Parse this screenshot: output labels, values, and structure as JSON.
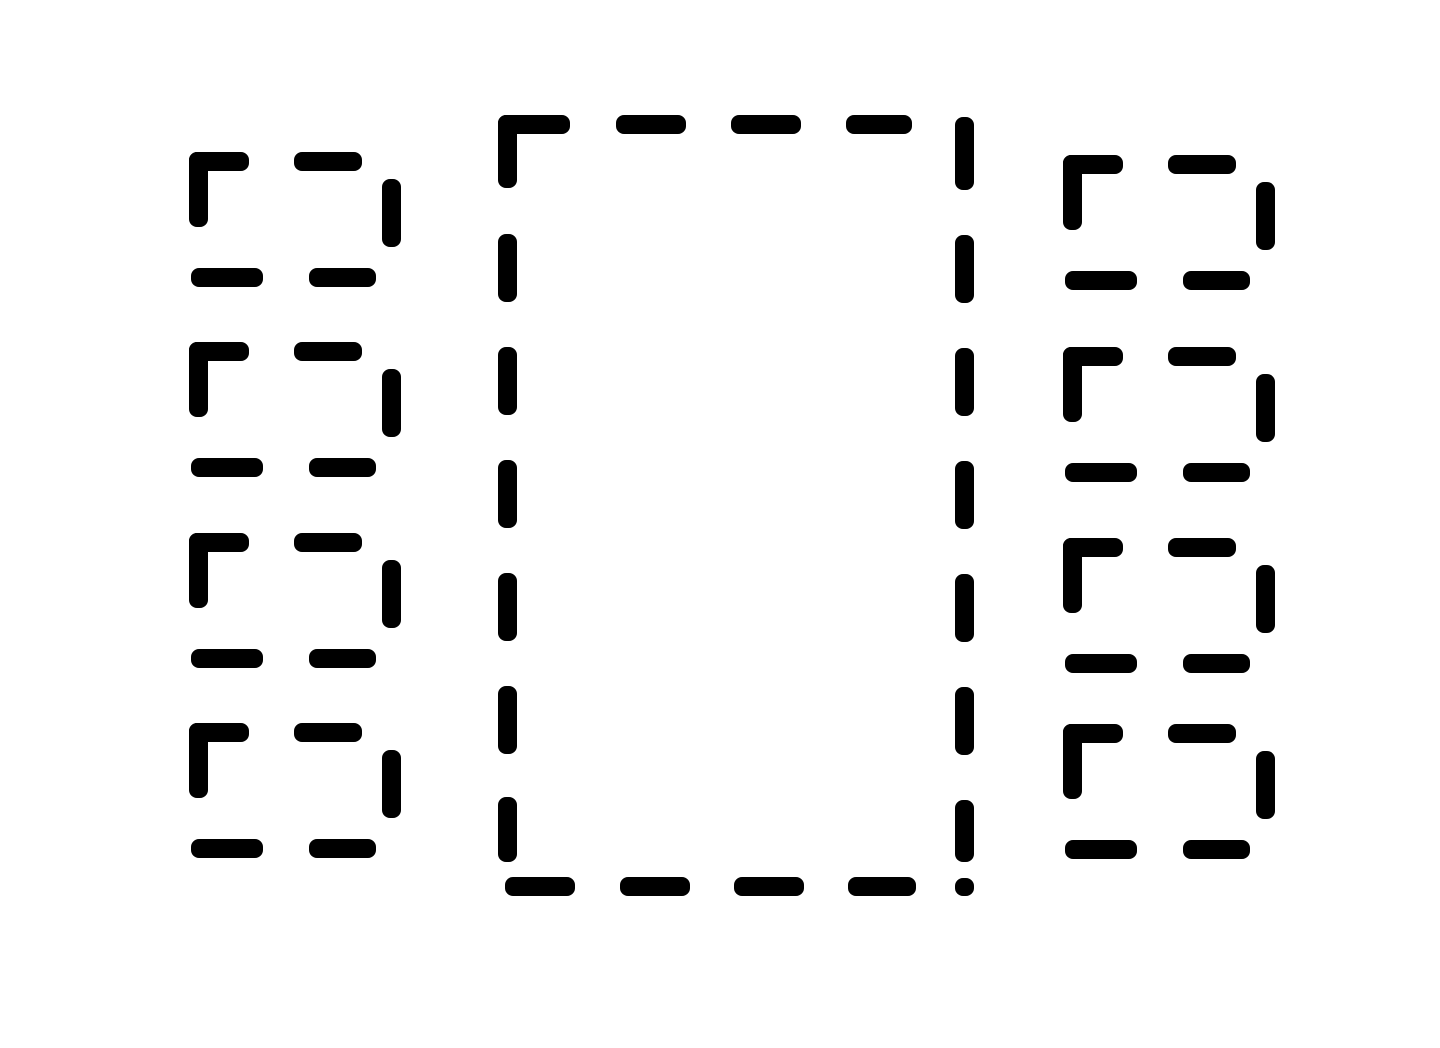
{
  "canvas": {
    "width": 1440,
    "height": 1048,
    "background_color": "#ffffff",
    "ink_color": "#000000",
    "stroke_thickness": 19,
    "dash_corner_radius": 8
  },
  "figure": {
    "description": "Large central dashed-outline rectangle flanked by a left column and a right column of four small dashed-outline rectangles",
    "center_rectangle": {
      "x": 498,
      "y": 115,
      "width": 476,
      "height": 781,
      "dashes": [
        {
          "name": "top-corner-horizontal",
          "x": 498,
          "y": 115,
          "w": 72,
          "h": 19
        },
        {
          "name": "top-corner-vertical",
          "x": 498,
          "y": 115,
          "w": 19,
          "h": 73
        },
        {
          "name": "top-dash-1",
          "x": 616,
          "y": 115,
          "w": 70,
          "h": 19
        },
        {
          "name": "top-dash-2",
          "x": 731,
          "y": 115,
          "w": 70,
          "h": 19
        },
        {
          "name": "top-dash-3",
          "x": 846,
          "y": 115,
          "w": 66,
          "h": 19
        },
        {
          "name": "right-dash-1",
          "x": 955,
          "y": 117,
          "w": 19,
          "h": 73
        },
        {
          "name": "right-dash-2",
          "x": 955,
          "y": 235,
          "w": 19,
          "h": 68
        },
        {
          "name": "right-dash-3",
          "x": 955,
          "y": 348,
          "w": 19,
          "h": 68
        },
        {
          "name": "right-dash-4",
          "x": 955,
          "y": 461,
          "w": 19,
          "h": 68
        },
        {
          "name": "right-dash-5",
          "x": 955,
          "y": 574,
          "w": 19,
          "h": 68
        },
        {
          "name": "right-dash-6",
          "x": 955,
          "y": 687,
          "w": 19,
          "h": 68
        },
        {
          "name": "right-dash-7",
          "x": 955,
          "y": 800,
          "w": 19,
          "h": 62
        },
        {
          "name": "bottom-right-corner-stub",
          "x": 955,
          "y": 878,
          "w": 19,
          "h": 18
        },
        {
          "name": "left-dash-1",
          "x": 498,
          "y": 234,
          "w": 19,
          "h": 68
        },
        {
          "name": "left-dash-2",
          "x": 498,
          "y": 347,
          "w": 19,
          "h": 68
        },
        {
          "name": "left-dash-3",
          "x": 498,
          "y": 460,
          "w": 19,
          "h": 68
        },
        {
          "name": "left-dash-4",
          "x": 498,
          "y": 573,
          "w": 19,
          "h": 68
        },
        {
          "name": "left-dash-5",
          "x": 498,
          "y": 686,
          "w": 19,
          "h": 68
        },
        {
          "name": "left-dash-6",
          "x": 498,
          "y": 797,
          "w": 19,
          "h": 65
        },
        {
          "name": "bottom-dash-1",
          "x": 505,
          "y": 877,
          "w": 70,
          "h": 19
        },
        {
          "name": "bottom-dash-2",
          "x": 620,
          "y": 877,
          "w": 70,
          "h": 19
        },
        {
          "name": "bottom-dash-3",
          "x": 734,
          "y": 877,
          "w": 70,
          "h": 19
        },
        {
          "name": "bottom-dash-4",
          "x": 848,
          "y": 877,
          "w": 68,
          "h": 19
        }
      ]
    },
    "small_box": {
      "width": 212,
      "height": 135,
      "dash_template": [
        {
          "name": "corner-horizontal",
          "x": 0,
          "y": 0,
          "w": 60,
          "h": 19
        },
        {
          "name": "corner-vertical",
          "x": 0,
          "y": 0,
          "w": 19,
          "h": 75
        },
        {
          "name": "top-dash",
          "x": 105,
          "y": 0,
          "w": 68,
          "h": 19
        },
        {
          "name": "right-dash",
          "x": 193,
          "y": 27,
          "w": 19,
          "h": 68
        },
        {
          "name": "bottom-dash-1",
          "x": 2,
          "y": 116,
          "w": 72,
          "h": 19
        },
        {
          "name": "bottom-dash-2",
          "x": 120,
          "y": 116,
          "w": 67,
          "h": 19
        }
      ]
    },
    "left_boxes": [
      {
        "id": "left-box-1",
        "x": 189,
        "y": 152
      },
      {
        "id": "left-box-2",
        "x": 189,
        "y": 342
      },
      {
        "id": "left-box-3",
        "x": 189,
        "y": 533
      },
      {
        "id": "left-box-4",
        "x": 189,
        "y": 723
      }
    ],
    "right_boxes": [
      {
        "id": "right-box-1",
        "x": 1063,
        "y": 155
      },
      {
        "id": "right-box-2",
        "x": 1063,
        "y": 347
      },
      {
        "id": "right-box-3",
        "x": 1063,
        "y": 538
      },
      {
        "id": "right-box-4",
        "x": 1063,
        "y": 724
      }
    ]
  }
}
